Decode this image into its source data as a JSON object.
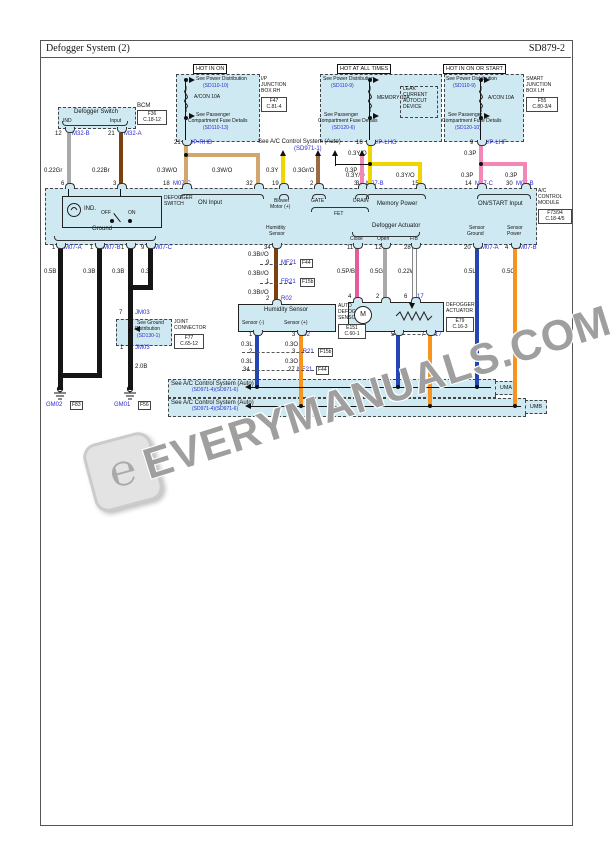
{
  "header": {
    "title": "Defogger System (2)",
    "code": "SD879-2"
  },
  "banners": {
    "hot_in_on": "HOT IN ON",
    "hot_at_all_times": "HOT AT ALL TIMES",
    "hot_in_on_or_start": "HOT IN ON OR START"
  },
  "power_left": {
    "see_power": "See Power Distribution",
    "see_power_ref": "(SD110-10)",
    "fuse": "A/CON 10A",
    "see_pass1": "See Passenger",
    "see_pass2": "Compartment Fuse Details",
    "see_pass_ref": "(SD110-13)",
    "annot1": "I/P",
    "annot2": "JUNCTION",
    "annot3": "BOX RH",
    "conn": "F47",
    "conn_code": "C.81-4",
    "out_pin": "21",
    "out_name": "I/P-RHB"
  },
  "power_mid": {
    "see_power": "See Power Distribution",
    "see_power_ref": "(SD110-9)",
    "fuse": "MEMORY 10A",
    "leak": [
      "LEAK",
      "CURRENT",
      "AUTOCUT",
      "DEVICE"
    ],
    "see_pass1": "See Passenger",
    "see_pass2": "Compartment Fuse Details",
    "see_pass_ref": "(SD120-6)",
    "out_pin": "16",
    "out_name": "I/P-LHG"
  },
  "power_right": {
    "see_power": "See Power Distribution",
    "see_power_ref": "(SD110-9)",
    "fuse": "A/CON 10A",
    "see_pass1": "See Passenger",
    "see_pass2": "Compartment Fuse Details",
    "see_pass_ref": "(SD120-10)",
    "annot1": "SMART",
    "annot2": "JUNCTION",
    "annot3": "BOX LH",
    "conn": "F55",
    "conn_code": "C.80-3/4",
    "out_pin": "9",
    "out_name": "I/P-LHF"
  },
  "defogger_switch": {
    "title": "Defogger Switch",
    "bump_ind": "IND",
    "bump_input": "Input",
    "annot": "BCM",
    "conn": "F36",
    "conn_code": "C.18-12",
    "pin1": "12",
    "pin1_name": "M32-B",
    "pin2": "21",
    "pin2_name": "M32-A",
    "wire1": "0.22Gr",
    "wire2": "0.22Br",
    "band_pin1": "6",
    "band_pin2": "3"
  },
  "on_input": {
    "wire_l": "0.3W/O",
    "wire_r": "0.3W/O",
    "pin_l": "18",
    "pin_l_name": "M07-C",
    "pin_r": "32",
    "label": "ON Input"
  },
  "acs_top": {
    "title": "See A/C Control System (Auto)",
    "ref": "(SD971-1)",
    "wire1": "0.3Y",
    "wire2": "0.3Gr/O",
    "wire3": "0.3P",
    "pin1": "19",
    "pin2": "2",
    "pin3": "3",
    "label1": "Blower",
    "label1b": "Motor (+)",
    "label2": "GATE",
    "label3": "DRAIN",
    "label_fet": "FET"
  },
  "memory": {
    "wire_top": "0.3Y/O",
    "wire_l": "0.3Y/O",
    "wire_r": "0.3Y/O",
    "pin_l": "31",
    "pin_l_name": "M07-B",
    "pin_r": "15",
    "label": "Memory Power"
  },
  "onstart": {
    "wire_top": "0.3P",
    "wire_l": "0.3P",
    "wire_r": "0.3P",
    "pin_l": "14",
    "pin_l_name": "M07-C",
    "pin_r": "30",
    "pin_r_name": "M07-B",
    "label": "ON/START Input"
  },
  "module": {
    "ind": "IND.",
    "off": "OFF",
    "on": "ON",
    "switch1": "DEFOGGER",
    "switch2": "SWITCH",
    "annot1": "A/C",
    "annot2": "CONTROL",
    "annot3": "MODULE",
    "conn": "F73/94",
    "conn_code": "C.18-4/5",
    "ground": "Ground",
    "humidity1": "Humidity",
    "humidity2": "Sensor",
    "actuator": "Defogger Actuator",
    "close": "Close",
    "open": "Open",
    "fb": "F/B",
    "sg1": "Sensor",
    "sg2": "Ground",
    "sp1": "Sensor",
    "sp2": "Power"
  },
  "grounds": {
    "pins": [
      {
        "pin": "1",
        "name": "M07-A"
      },
      {
        "pin": "1",
        "name": "M07-B"
      },
      {
        "pin": "1",
        "name": ""
      },
      {
        "pin": "9",
        "name": "M07-C"
      }
    ],
    "wire1": "0.5B",
    "wire2": "0.3B",
    "wire3": "0.3B",
    "wire4": "0.3B",
    "jm_pin_top": "7",
    "jm_top_name": "JM03",
    "dist1": "See Ground",
    "dist2": "Distribution",
    "dist_ref": "(SD130-1)",
    "jm_pin_bot": "1",
    "jm_bot_name": "JM03",
    "joint1": "JOINT",
    "joint2": "CONNECTOR",
    "joint_conn": "F77",
    "joint_code": "C.65-12",
    "wire_20": "2.0B",
    "gm_left": "GM02",
    "gm_left_box": "F83",
    "gm_right": "GM01",
    "gm_right_box": "F56"
  },
  "humidity": {
    "top_pin": "34",
    "wire": "0.3Br/O",
    "c1_pin": "9",
    "c1_name": "MF21",
    "c1_box": "F44",
    "c2_pin": "1",
    "c2_name": "FR21",
    "c2_box": "F15b",
    "c3_pin": "2",
    "c3_name": "R02",
    "box_title": "Humidity Sensor",
    "annot1": "AUTO",
    "annot2": "DEFOGGER",
    "annot3": "SENSOR",
    "conn": "E151",
    "conn_code": "C.60-1",
    "minus": "Sensor (-)",
    "plus": "Sensor (+)",
    "r1l": "1",
    "r1r": "3",
    "r1r_name": "R02",
    "wl": "0.3L",
    "wr": "0.3O",
    "r2l": "2",
    "r2r": "3",
    "r2r_name": "FR21",
    "r2r_box": "F15b",
    "r3l": "34",
    "r3r": "27",
    "r3r_name": "MF21",
    "r3r_box": "F44"
  },
  "actuator": {
    "pin1": "11",
    "pin2": "12",
    "pin3": "28",
    "wire1": "0.5P/B",
    "wire2": "0.5Gr",
    "wire3": "0.22W",
    "mid1": "4",
    "mid2": "2",
    "mid3": "6",
    "mid3_name": "M17",
    "motor": "M",
    "annot1": "DEFOGGER",
    "annot2": "ACTUATOR",
    "conn": "E79",
    "conn_code": "C.16-3",
    "bot1": "5",
    "bot2": "7",
    "bot2_name": "M17"
  },
  "sensors": {
    "g_pin": "20",
    "g_name": "M07-A",
    "g_wire": "0.5L",
    "p_pin": "4",
    "p_name": "M07-B",
    "p_wire": "0.5O"
  },
  "bands": {
    "text": "See A/C Control System (Auto)",
    "ref": "(SD971-4)(SD971-6)",
    "label1": "UMA",
    "label2": "UMB"
  },
  "watermark": {
    "text": "EVERYMANUALS.COM",
    "logo_glyph": "℮"
  }
}
